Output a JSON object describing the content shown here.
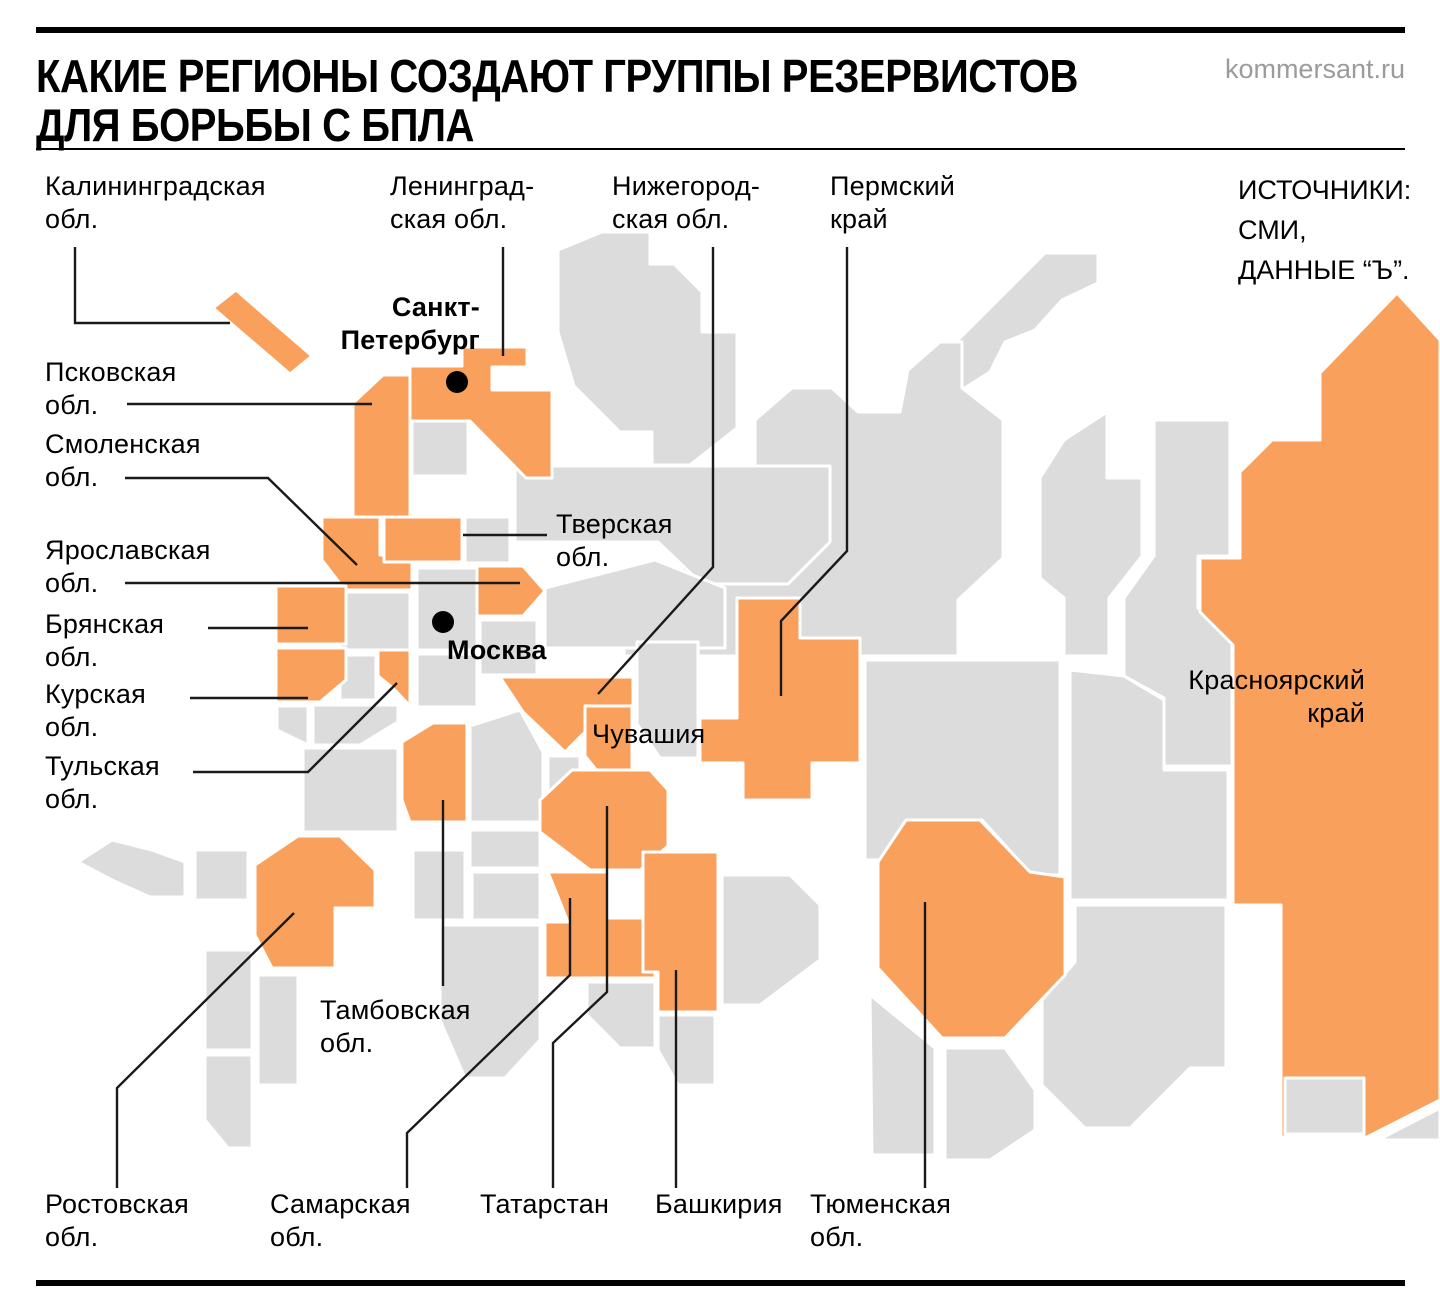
{
  "header": {
    "title_line1": "КАКИЕ РЕГИОНЫ СОЗДАЮТ ГРУППЫ РЕЗЕРВИСТОВ",
    "title_line2": "ДЛЯ БОРЬБЫ С БПЛА",
    "brand": "kommersant.ru"
  },
  "sources": {
    "line1": "ИСТОЧНИКИ:",
    "line2": "СМИ,",
    "line3": "ДАННЫЕ “Ъ”."
  },
  "cities": {
    "spb": {
      "line1": "Санкт-",
      "line2": "Петербург"
    },
    "moscow": {
      "name": "Москва"
    }
  },
  "labels": {
    "kaliningrad": {
      "line1": "Калининградская",
      "line2": "обл."
    },
    "leningrad": {
      "line1": "Ленинград-",
      "line2": "ская обл."
    },
    "nizhegorod": {
      "line1": "Нижегород-",
      "line2": "ская обл."
    },
    "perm": {
      "line1": "Пермский",
      "line2": "край"
    },
    "pskov": {
      "line1": "Псковская",
      "line2": "обл."
    },
    "smolensk": {
      "line1": "Смоленская",
      "line2": "обл."
    },
    "yaroslavl": {
      "line1": "Ярославская",
      "line2": "обл."
    },
    "bryansk": {
      "line1": "Брянская",
      "line2": "обл."
    },
    "kursk": {
      "line1": "Курская",
      "line2": "обл."
    },
    "tula": {
      "line1": "Тульская",
      "line2": "обл."
    },
    "tver": {
      "line1": "Тверская",
      "line2": "обл."
    },
    "chuvashia": {
      "line1": "Чувашия"
    },
    "krasnoyarsk": {
      "line1": "Красноярский",
      "line2": "край"
    },
    "tambov": {
      "line1": "Тамбовская",
      "line2": "обл."
    },
    "rostov": {
      "line1": "Ростовская",
      "line2": "обл."
    },
    "samara": {
      "line1": "Самарская",
      "line2": "обл."
    },
    "tatarstan": {
      "line1": "Татарстан"
    },
    "bashkiria": {
      "line1": "Башкирия"
    },
    "tyumen": {
      "line1": "Тюменская",
      "line2": "обл."
    }
  },
  "colors": {
    "region_highlight": "#F9A15C",
    "region_base": "#DCDCDC",
    "callout_line": "#1A1A1A",
    "brand_text": "#9B9B9B",
    "text": "#000000",
    "background": "#FFFFFF"
  }
}
